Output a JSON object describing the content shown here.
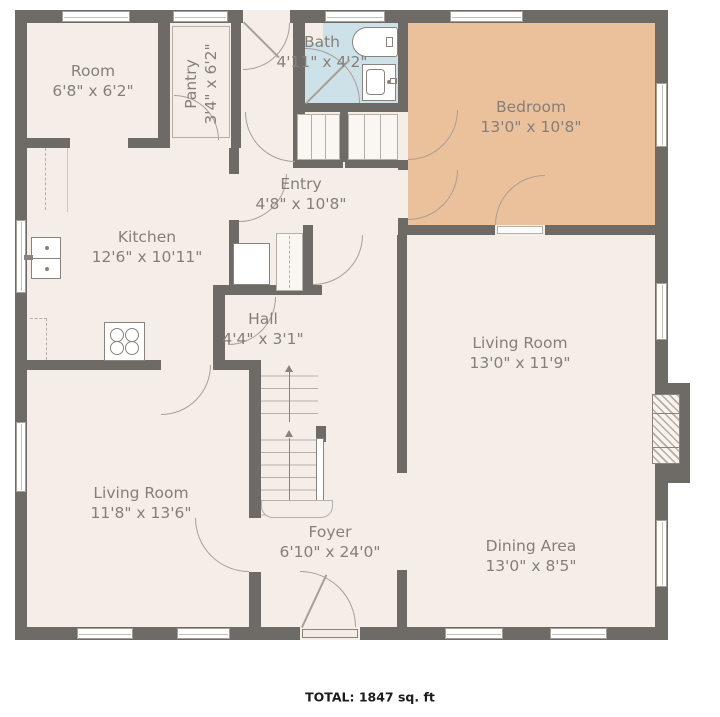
{
  "plan": {
    "rooms": [
      {
        "id": "room",
        "name": "Room",
        "dims": "6'8\" x 6'2\""
      },
      {
        "id": "pantry",
        "name": "Pantry",
        "dims": "3'4\" x 6'2\""
      },
      {
        "id": "bath",
        "name": "Bath",
        "dims": "4'11\" x 4'2\""
      },
      {
        "id": "bedroom",
        "name": "Bedroom",
        "dims": "13'0\" x 10'8\""
      },
      {
        "id": "entry",
        "name": "Entry",
        "dims": "4'8\" x 10'8\""
      },
      {
        "id": "kitchen",
        "name": "Kitchen",
        "dims": "12'6\" x 10'11\""
      },
      {
        "id": "hall",
        "name": "Hall",
        "dims": "4'4\" x 3'1\""
      },
      {
        "id": "living_room_right",
        "name": "Living Room",
        "dims": "13'0\" x 11'9\""
      },
      {
        "id": "living_room_left",
        "name": "Living Room",
        "dims": "11'8\" x 13'6\""
      },
      {
        "id": "foyer",
        "name": "Foyer",
        "dims": "6'10\" x 24'0\""
      },
      {
        "id": "dining_area",
        "name": "Dining Area",
        "dims": "13'0\" x 8'5\""
      }
    ],
    "total_label": "TOTAL: 1847 sq. ft",
    "colors": {
      "wall": "#6e6a66",
      "floor": "#f5ede7",
      "bedroom_fill": "#ebc19c",
      "bath_fill": "#cde2e8",
      "label_text": "#857f79"
    },
    "icons": [
      "bathtub-icon",
      "bathroom-sink-icon",
      "kitchen-sink-icon",
      "stove-icon",
      "refrigerator-icon",
      "fireplace-icon",
      "stairs-up-arrow-icon"
    ]
  }
}
